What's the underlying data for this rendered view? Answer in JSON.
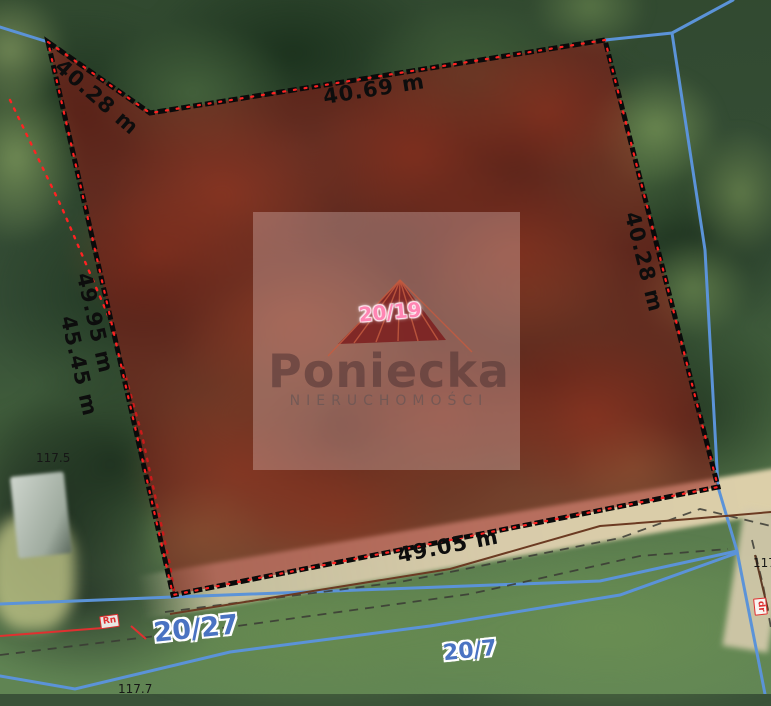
{
  "map": {
    "region_labels": {
      "parcel_main": "20/19",
      "parcel_left": "20/27",
      "parcel_bottom": "20/7"
    },
    "measurements": {
      "top_left": "40.28 m",
      "top": "40.69 m",
      "right": "40.28 m",
      "left_outer": "49.95 m",
      "left_inner": "45.45 m",
      "bottom": "49.05 m"
    },
    "elevations": {
      "left": "117.5",
      "bottom": "117.7",
      "right_partial": "117"
    },
    "land_use_labels": {
      "left": "Rn",
      "right": "dr"
    },
    "watermark": {
      "brand": "Poniecka",
      "subtitle": "NIERUCHOMOŚCI"
    },
    "colors": {
      "parcel_overlay": "rgba(150,18,18,0.5)",
      "parcel_border": "#0a0a0a",
      "parcel_border_dots": "#ff2222",
      "boundary_blue": "#5b93d8",
      "survey_red": "#e03030",
      "parcel_label_blue": "#4a73c2",
      "parcel_label_pink": "#ff86b3"
    }
  }
}
